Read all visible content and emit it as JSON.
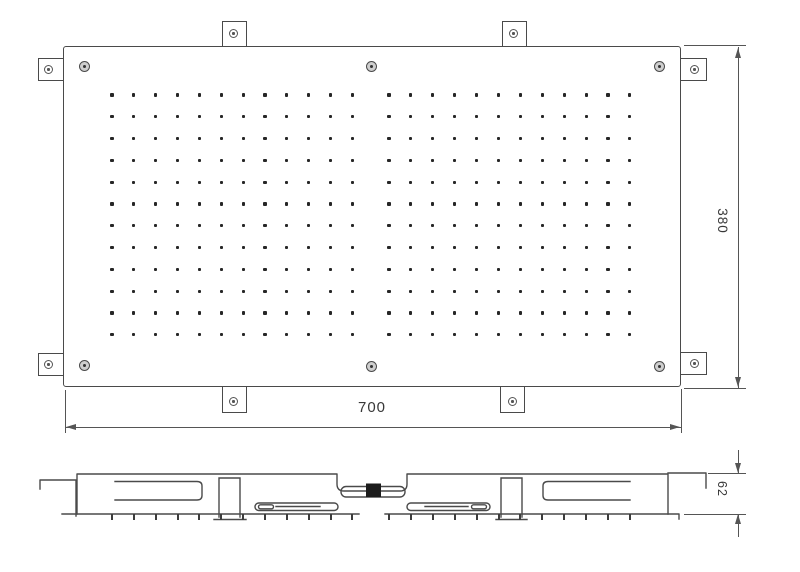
{
  "drawing": {
    "type": "technical-drawing",
    "subject": "recessed ceiling rain shower head, top view and side section",
    "colors": {
      "line": "#4a4a4a",
      "dim_line": "#555555",
      "text": "#383838",
      "inlet_fill": "#1c1c1c",
      "background": "#ffffff"
    },
    "dimensions": {
      "width": {
        "label": "700"
      },
      "height": {
        "label": "380"
      },
      "depth": {
        "label": "62"
      }
    },
    "top_view": {
      "screw_count": 6,
      "mounting_tab_count": 8,
      "nozzle_grid": {
        "rows": 12,
        "row_start_y": 95,
        "row_step": 21.8,
        "blocks": [
          {
            "start_x": 112,
            "cols": 12,
            "col_step": 21.85
          },
          {
            "start_x": 389,
            "cols": 12,
            "col_step": 21.9
          }
        ]
      }
    },
    "side_view": {
      "tick_y": 514,
      "tick_height": 6
    }
  }
}
